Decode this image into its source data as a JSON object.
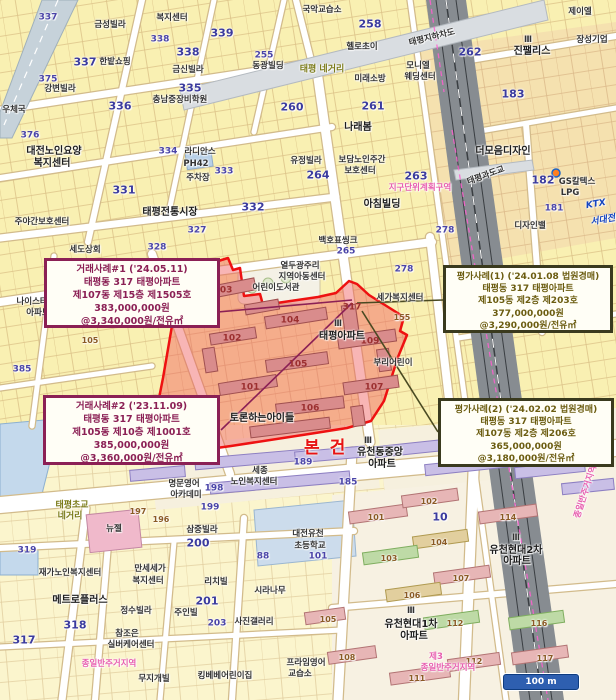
{
  "map": {
    "subject_label": "본건",
    "scale_bar": "100 m",
    "colors": {
      "subject_fill": "#f05a5a",
      "subject_stroke": "#ee1111",
      "sale_callout": "#8b2055",
      "appraisal_callout": "#6b5c10",
      "zone_boundary_pink": "#ff5fd0"
    },
    "labels": [
      {
        "t": "금성빌라",
        "x": 110,
        "y": 25,
        "c": "nms"
      },
      {
        "t": "337",
        "x": 48,
        "y": 18,
        "c": "n2"
      },
      {
        "t": "337",
        "x": 85,
        "y": 62,
        "c": "n1"
      },
      {
        "t": "338",
        "x": 160,
        "y": 40,
        "c": "n2"
      },
      {
        "t": "338",
        "x": 188,
        "y": 52,
        "c": "n1"
      },
      {
        "t": "339",
        "x": 222,
        "y": 33,
        "c": "n1"
      },
      {
        "t": "335",
        "x": 190,
        "y": 88,
        "c": "n1"
      },
      {
        "t": "336",
        "x": 120,
        "y": 106,
        "c": "n1"
      },
      {
        "t": "375",
        "x": 48,
        "y": 80,
        "c": "n2"
      },
      {
        "t": "강변빌라",
        "x": 60,
        "y": 89,
        "c": "nms"
      },
      {
        "t": "금신빌라",
        "x": 188,
        "y": 70,
        "c": "nms"
      },
      {
        "t": "한밭쇼핑",
        "x": 115,
        "y": 62,
        "c": "nms"
      },
      {
        "t": "복지센터",
        "x": 172,
        "y": 18,
        "c": "nms"
      },
      {
        "t": "충남중장비학원",
        "x": 180,
        "y": 100,
        "c": "nms"
      },
      {
        "t": "255",
        "x": 264,
        "y": 56,
        "c": "n2"
      },
      {
        "t": "동광빌딩",
        "x": 268,
        "y": 66,
        "c": "nms"
      },
      {
        "t": "우체국",
        "x": 14,
        "y": 110,
        "c": "nms"
      },
      {
        "t": "376",
        "x": 30,
        "y": 136,
        "c": "n2"
      },
      {
        "t": "대전노인요양",
        "x": 54,
        "y": 152,
        "c": "nm"
      },
      {
        "t": "복지센터",
        "x": 52,
        "y": 164,
        "c": "nm"
      },
      {
        "t": "주야간보호센터",
        "x": 42,
        "y": 222,
        "c": "nms"
      },
      {
        "t": "세도상회",
        "x": 85,
        "y": 250,
        "c": "nms"
      },
      {
        "t": "331",
        "x": 124,
        "y": 190,
        "c": "n1"
      },
      {
        "t": "334",
        "x": 168,
        "y": 152,
        "c": "n2"
      },
      {
        "t": "라디안스",
        "x": 200,
        "y": 152,
        "c": "nms"
      },
      {
        "t": "PH42",
        "x": 196,
        "y": 164,
        "c": "nms"
      },
      {
        "t": "주차장",
        "x": 198,
        "y": 178,
        "c": "nms"
      },
      {
        "t": "333",
        "x": 224,
        "y": 172,
        "c": "n2"
      },
      {
        "t": "태평전통시장",
        "x": 170,
        "y": 213,
        "c": "nm"
      },
      {
        "t": "327",
        "x": 197,
        "y": 231,
        "c": "n2"
      },
      {
        "t": "328",
        "x": 157,
        "y": 248,
        "c": "n2"
      },
      {
        "t": "국악교습소",
        "x": 322,
        "y": 10,
        "c": "nms"
      },
      {
        "t": "258",
        "x": 370,
        "y": 24,
        "c": "n1"
      },
      {
        "t": "헬로초이",
        "x": 362,
        "y": 47,
        "c": "nms"
      },
      {
        "t": "태평 네거리",
        "x": 322,
        "y": 70,
        "c": "ol"
      },
      {
        "t": "미래소방",
        "x": 370,
        "y": 79,
        "c": "nms"
      },
      {
        "t": "모니엘",
        "x": 418,
        "y": 66,
        "c": "nms"
      },
      {
        "t": "웨딩센터",
        "x": 420,
        "y": 77,
        "c": "nms"
      },
      {
        "t": "262",
        "x": 470,
        "y": 52,
        "c": "n1"
      },
      {
        "t": "261",
        "x": 373,
        "y": 106,
        "c": "n1"
      },
      {
        "t": "Ⅲ",
        "x": 528,
        "y": 40,
        "c": "nms"
      },
      {
        "t": "진팰리스",
        "x": 532,
        "y": 52,
        "c": "nm"
      },
      {
        "t": "제이엘",
        "x": 580,
        "y": 12,
        "c": "nms"
      },
      {
        "t": "장성기업",
        "x": 592,
        "y": 40,
        "c": "nms"
      },
      {
        "t": "183",
        "x": 513,
        "y": 94,
        "c": "n1"
      },
      {
        "t": "태평지하차도",
        "x": 432,
        "y": 38,
        "c": "nms",
        "r": -14
      },
      {
        "t": "지구단위계획구역",
        "x": 420,
        "y": 188,
        "c": "pk"
      },
      {
        "t": "263",
        "x": 416,
        "y": 176,
        "c": "n1"
      },
      {
        "t": "265",
        "x": 346,
        "y": 252,
        "c": "n2"
      },
      {
        "t": "278",
        "x": 404,
        "y": 270,
        "c": "n2"
      },
      {
        "t": "나래봄",
        "x": 358,
        "y": 128,
        "c": "nm"
      },
      {
        "t": "보담노인주간",
        "x": 362,
        "y": 160,
        "c": "nms"
      },
      {
        "t": "보호센터",
        "x": 360,
        "y": 171,
        "c": "nms"
      },
      {
        "t": "유정빌라",
        "x": 306,
        "y": 161,
        "c": "nms"
      },
      {
        "t": "264",
        "x": 318,
        "y": 175,
        "c": "n1"
      },
      {
        "t": "260",
        "x": 292,
        "y": 107,
        "c": "n1"
      },
      {
        "t": "아침빌딩",
        "x": 382,
        "y": 205,
        "c": "nm"
      },
      {
        "t": "332",
        "x": 253,
        "y": 207,
        "c": "n1"
      },
      {
        "t": "백호표씽크",
        "x": 338,
        "y": 241,
        "c": "nms"
      },
      {
        "t": "278",
        "x": 445,
        "y": 231,
        "c": "n2"
      },
      {
        "t": "더모음디자인",
        "x": 503,
        "y": 152,
        "c": "nm"
      },
      {
        "t": "태평과도교",
        "x": 486,
        "y": 176,
        "c": "nms",
        "r": -20
      },
      {
        "t": "182",
        "x": 543,
        "y": 180,
        "c": "n1"
      },
      {
        "t": "GS칼텍스",
        "x": 577,
        "y": 182,
        "c": "nms"
      },
      {
        "t": "LPG",
        "x": 570,
        "y": 193,
        "c": "nms"
      },
      {
        "t": "181",
        "x": 554,
        "y": 209,
        "c": "n2"
      },
      {
        "t": "디자인밸",
        "x": 530,
        "y": 226,
        "c": "nms"
      },
      {
        "t": "KTX",
        "x": 596,
        "y": 205,
        "c": "bl",
        "r": -10
      },
      {
        "t": "서대전",
        "x": 603,
        "y": 221,
        "c": "bl",
        "r": -10
      },
      {
        "t": "열두광주리",
        "x": 300,
        "y": 266,
        "c": "nms"
      },
      {
        "t": "지역아동센터",
        "x": 302,
        "y": 277,
        "c": "nms"
      },
      {
        "t": "어린이도서관",
        "x": 276,
        "y": 288,
        "c": "nms"
      },
      {
        "t": "103",
        "x": 223,
        "y": 291,
        "c": "rn"
      },
      {
        "t": "104",
        "x": 290,
        "y": 321,
        "c": "rn"
      },
      {
        "t": "102",
        "x": 232,
        "y": 339,
        "c": "rn"
      },
      {
        "t": "105",
        "x": 298,
        "y": 365,
        "c": "rn"
      },
      {
        "t": "101",
        "x": 250,
        "y": 388,
        "c": "rn"
      },
      {
        "t": "106",
        "x": 310,
        "y": 409,
        "c": "rn"
      },
      {
        "t": "107",
        "x": 374,
        "y": 388,
        "c": "rn"
      },
      {
        "t": "109",
        "x": 370,
        "y": 342,
        "c": "rn"
      },
      {
        "t": "317",
        "x": 352,
        "y": 308,
        "c": "rn"
      },
      {
        "t": "Ⅲ",
        "x": 338,
        "y": 324,
        "c": "nms"
      },
      {
        "t": "태평아파트",
        "x": 342,
        "y": 337,
        "c": "nm"
      },
      {
        "t": "부리어린이",
        "x": 393,
        "y": 363,
        "c": "nms"
      },
      {
        "t": "토론하는아이들",
        "x": 262,
        "y": 419,
        "c": "nm"
      },
      {
        "t": "세가복지센터",
        "x": 400,
        "y": 298,
        "c": "nms"
      },
      {
        "t": "155",
        "x": 402,
        "y": 318,
        "c": "bn"
      },
      {
        "t": "나이스타운",
        "x": 36,
        "y": 302,
        "c": "nms"
      },
      {
        "t": "아파트",
        "x": 38,
        "y": 313,
        "c": "nms"
      },
      {
        "t": "385",
        "x": 22,
        "y": 370,
        "c": "n2"
      },
      {
        "t": "105",
        "x": 90,
        "y": 341,
        "c": "bn"
      },
      {
        "t": "Ⅲ",
        "x": 368,
        "y": 441,
        "c": "nms"
      },
      {
        "t": "유천동중앙",
        "x": 380,
        "y": 453,
        "c": "nm"
      },
      {
        "t": "아파트",
        "x": 382,
        "y": 465,
        "c": "nm"
      },
      {
        "t": "189",
        "x": 303,
        "y": 463,
        "c": "n2"
      },
      {
        "t": "185",
        "x": 348,
        "y": 483,
        "c": "n2"
      },
      {
        "t": "세종",
        "x": 260,
        "y": 471,
        "c": "nms"
      },
      {
        "t": "노인복지센터",
        "x": 254,
        "y": 482,
        "c": "nms"
      },
      {
        "t": "태평초교",
        "x": 72,
        "y": 506,
        "c": "ol"
      },
      {
        "t": "네거리",
        "x": 70,
        "y": 517,
        "c": "ol"
      },
      {
        "t": "197",
        "x": 138,
        "y": 512,
        "c": "bn"
      },
      {
        "t": "196",
        "x": 161,
        "y": 520,
        "c": "bn"
      },
      {
        "t": "198",
        "x": 214,
        "y": 489,
        "c": "n2"
      },
      {
        "t": "199",
        "x": 210,
        "y": 508,
        "c": "n2"
      },
      {
        "t": "명문영어",
        "x": 184,
        "y": 484,
        "c": "nms"
      },
      {
        "t": "아카데미",
        "x": 186,
        "y": 495,
        "c": "nms"
      },
      {
        "t": "삼중빌라",
        "x": 202,
        "y": 530,
        "c": "nms"
      },
      {
        "t": "200",
        "x": 198,
        "y": 543,
        "c": "n1"
      },
      {
        "t": "319",
        "x": 27,
        "y": 551,
        "c": "n2"
      },
      {
        "t": "뉴젤",
        "x": 114,
        "y": 529,
        "c": "nms"
      },
      {
        "t": "대전유천",
        "x": 308,
        "y": 534,
        "c": "nms"
      },
      {
        "t": "초등학교",
        "x": 310,
        "y": 546,
        "c": "nms"
      },
      {
        "t": "101",
        "x": 318,
        "y": 557,
        "c": "n2"
      },
      {
        "t": "88",
        "x": 263,
        "y": 557,
        "c": "n2"
      },
      {
        "t": "시라나무",
        "x": 270,
        "y": 591,
        "c": "nms"
      },
      {
        "t": "만세세가",
        "x": 150,
        "y": 569,
        "c": "nms"
      },
      {
        "t": "복지센터",
        "x": 148,
        "y": 581,
        "c": "nms"
      },
      {
        "t": "재가노인복지센터",
        "x": 70,
        "y": 573,
        "c": "nms"
      },
      {
        "t": "메트로플러스",
        "x": 80,
        "y": 601,
        "c": "nm"
      },
      {
        "t": "318",
        "x": 75,
        "y": 625,
        "c": "n1"
      },
      {
        "t": "317",
        "x": 24,
        "y": 640,
        "c": "n1"
      },
      {
        "t": "정수빌라",
        "x": 136,
        "y": 611,
        "c": "nms"
      },
      {
        "t": "리치빌",
        "x": 216,
        "y": 582,
        "c": "nms"
      },
      {
        "t": "201",
        "x": 207,
        "y": 601,
        "c": "n1"
      },
      {
        "t": "주인빌",
        "x": 186,
        "y": 613,
        "c": "nms"
      },
      {
        "t": "203",
        "x": 217,
        "y": 624,
        "c": "n2"
      },
      {
        "t": "사진갤러리",
        "x": 254,
        "y": 622,
        "c": "nms"
      },
      {
        "t": "참조은",
        "x": 127,
        "y": 634,
        "c": "nms"
      },
      {
        "t": "실버케어센터",
        "x": 131,
        "y": 645,
        "c": "nms"
      },
      {
        "t": "종일반주거지역",
        "x": 109,
        "y": 664,
        "c": "pk"
      },
      {
        "t": "무지개빌",
        "x": 154,
        "y": 679,
        "c": "nms"
      },
      {
        "t": "킹베베어린이집",
        "x": 225,
        "y": 676,
        "c": "nms"
      },
      {
        "t": "프라임영어",
        "x": 306,
        "y": 663,
        "c": "nms"
      },
      {
        "t": "교습소",
        "x": 300,
        "y": 674,
        "c": "nms"
      },
      {
        "t": "105",
        "x": 328,
        "y": 620,
        "c": "bn"
      },
      {
        "t": "108",
        "x": 347,
        "y": 658,
        "c": "bn"
      },
      {
        "t": "10",
        "x": 440,
        "y": 517,
        "c": "n1"
      },
      {
        "t": "101",
        "x": 376,
        "y": 518,
        "c": "bn"
      },
      {
        "t": "102",
        "x": 429,
        "y": 502,
        "c": "bn"
      },
      {
        "t": "104",
        "x": 439,
        "y": 543,
        "c": "bn"
      },
      {
        "t": "103",
        "x": 389,
        "y": 559,
        "c": "bn"
      },
      {
        "t": "107",
        "x": 461,
        "y": 579,
        "c": "bn"
      },
      {
        "t": "106",
        "x": 412,
        "y": 596,
        "c": "bn"
      },
      {
        "t": "112",
        "x": 455,
        "y": 624,
        "c": "bn"
      },
      {
        "t": "114",
        "x": 508,
        "y": 518,
        "c": "bn"
      },
      {
        "t": "116",
        "x": 539,
        "y": 624,
        "c": "bn"
      },
      {
        "t": "117",
        "x": 545,
        "y": 659,
        "c": "bn"
      },
      {
        "t": "111",
        "x": 417,
        "y": 679,
        "c": "bn"
      },
      {
        "t": "112",
        "x": 474,
        "y": 662,
        "c": "bn"
      },
      {
        "t": "Ⅲ",
        "x": 516,
        "y": 538,
        "c": "nms"
      },
      {
        "t": "유천현대2차",
        "x": 516,
        "y": 551,
        "c": "nm"
      },
      {
        "t": "아파트",
        "x": 517,
        "y": 562,
        "c": "nm"
      },
      {
        "t": "Ⅲ",
        "x": 411,
        "y": 611,
        "c": "nms"
      },
      {
        "t": "유천현대1차",
        "x": 411,
        "y": 625,
        "c": "nm"
      },
      {
        "t": "아파트",
        "x": 414,
        "y": 637,
        "c": "nm"
      },
      {
        "t": "제3",
        "x": 436,
        "y": 657,
        "c": "pk"
      },
      {
        "t": "종일반주거지역",
        "x": 448,
        "y": 668,
        "c": "pk"
      },
      {
        "t": "종일반주거지역",
        "x": 586,
        "y": 492,
        "c": "pk",
        "r": -72
      },
      {
        "t": "187",
        "x": 558,
        "y": 684,
        "c": "n2"
      }
    ]
  },
  "callouts": {
    "sale1": {
      "lines": [
        "거래사례#1 ('24.05.11)",
        "태평동 317 태평아파트",
        "제107동 제15층 제1505호",
        "383,000,000원",
        "@3,340,000원/전유㎡"
      ]
    },
    "sale2": {
      "lines": [
        "거래사례#2 ('23.11.09)",
        "태평동 317 태평아파트",
        "제105동 제10층 제1001호",
        "385,000,000원",
        "@3,360,000원/전유㎡"
      ]
    },
    "appraisal1": {
      "lines": [
        "평가사례(1) ('24.01.08 법원경매)",
        "태평동 317 태평아파트",
        "제105동 제2층 제203호",
        "377,000,000원",
        "@3,290,000원/전유㎡"
      ]
    },
    "appraisal2": {
      "lines": [
        "평가사례(2) ('24.02.02 법원경매)",
        "태평동 317 태평아파트",
        "제107동 제2층 제206호",
        "365,000,000원",
        "@3,180,000원/전유㎡"
      ]
    }
  }
}
